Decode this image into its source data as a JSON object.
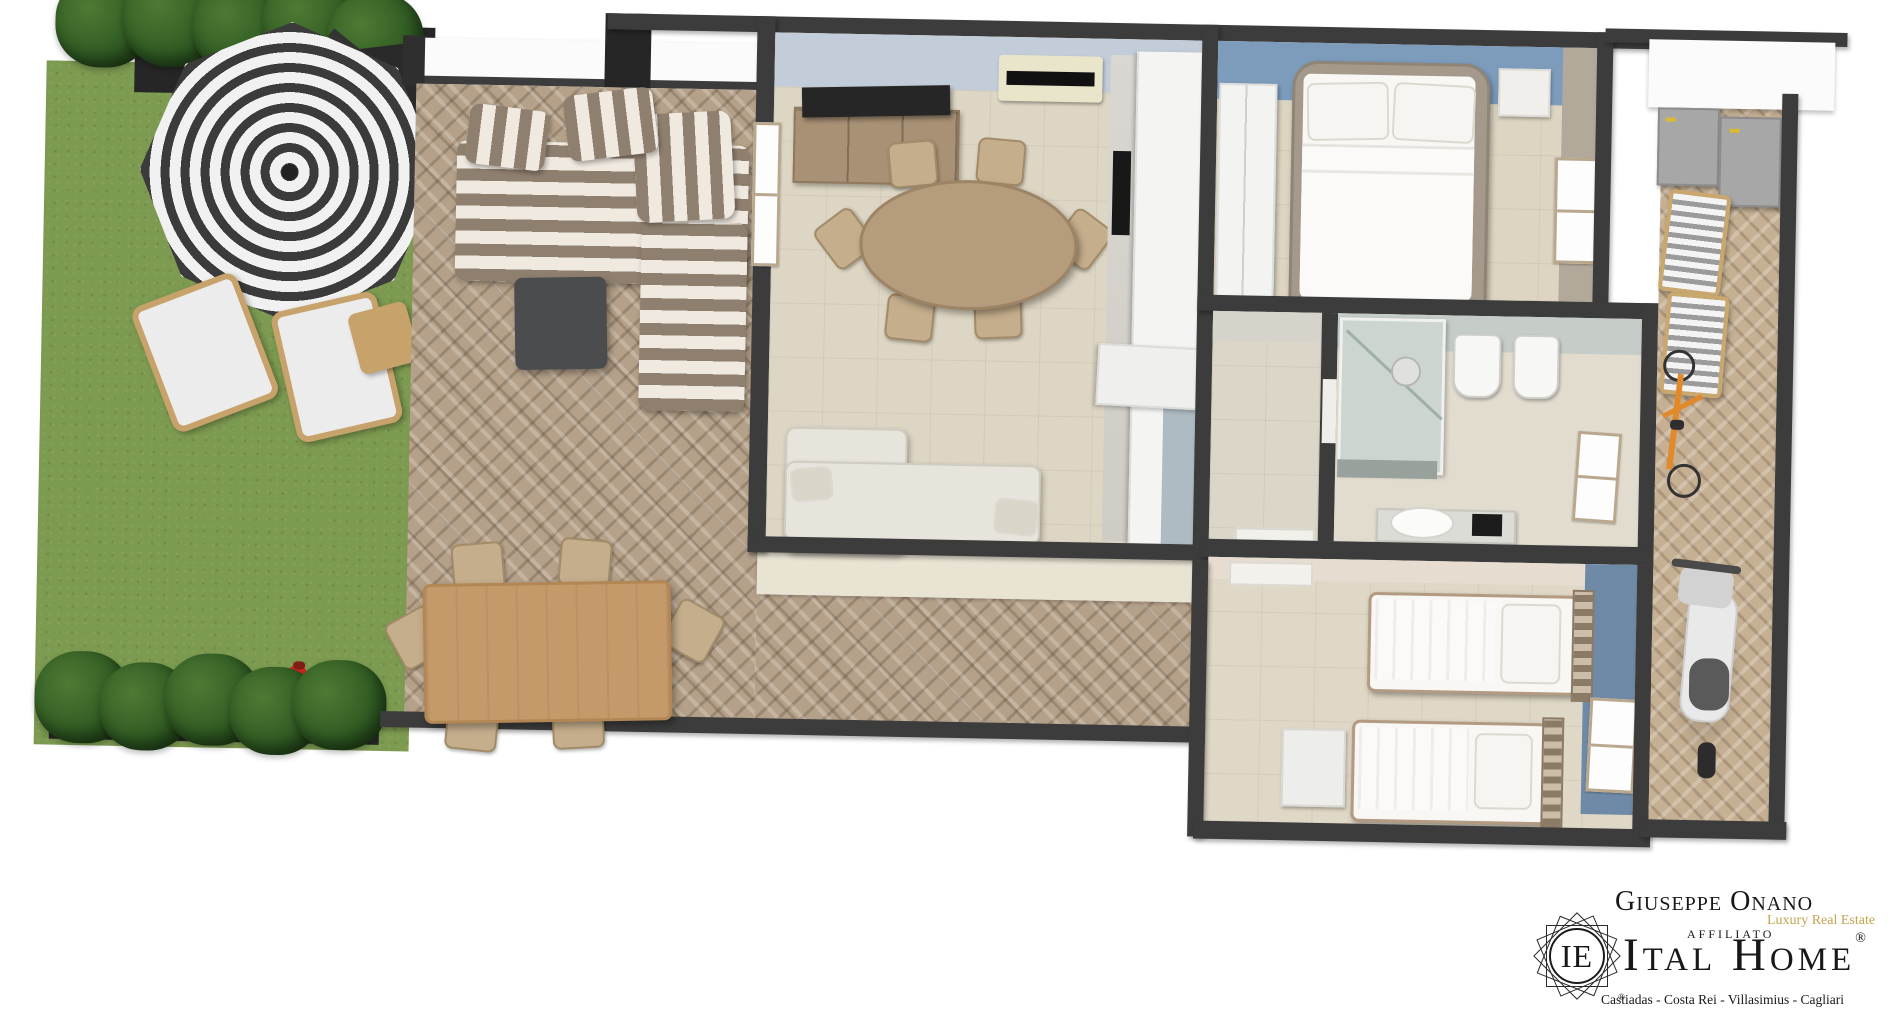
{
  "branding": {
    "agent_name": "Giuseppe Onano",
    "tagline": "Luxury Real Estate",
    "affiliation_label": "AFFILIATO",
    "brand_name": "Ital Home",
    "registered_mark": "®",
    "emblem_monogram": "IE",
    "emblem_registered_mark": "®",
    "service_areas": "Castiadas - Costa Rei - Villasimius - Cagliari",
    "colors": {
      "text": "#181818",
      "tagline_gold": "#c4a44e"
    }
  },
  "floor_plan": {
    "palette": {
      "wall": "#3c3c3c",
      "grass": "#7c9a50",
      "terrace_pavers": "#b5a189",
      "side_terrace_pavers": "#c6b093",
      "interior_floor": "#ded6c4",
      "living_wall_face": "#c2cdd9",
      "master_accent_wall": "#7d9cbc",
      "bedroom2_accent_wall": "#6f8aa6",
      "bathroom_wall_face": "#c6cdc8",
      "cream_band": "#e9e3d3",
      "umbrella_stripe_dark": "#3b3b3b",
      "umbrella_stripe_light": "#f1f1f1",
      "sofa_stripe_dark": "#8f7f6f",
      "sofa_stripe_light": "#efe9e0",
      "wood": "#c49a6b"
    },
    "areas": [
      "garden-lawn",
      "hedge-planters",
      "patio-terrace",
      "living-dining-room",
      "kitchen",
      "master-bedroom",
      "hallway",
      "bathroom",
      "second-bedroom",
      "side-terrace"
    ],
    "furniture": [
      "parasol",
      "sun-loungers",
      "kids-tricycle",
      "outdoor-sofa",
      "outdoor-coffee-table",
      "outdoor-dining-table",
      "tv-sideboard",
      "air-conditioner",
      "dining-table-with-chairs",
      "kitchen-units",
      "living-sofa",
      "double-bed",
      "wardrobe",
      "shower",
      "bidet",
      "toilet",
      "washbasin-vanity",
      "single-beds",
      "deck-chairs",
      "storage-cabinets",
      "bicycle",
      "scooter"
    ]
  }
}
